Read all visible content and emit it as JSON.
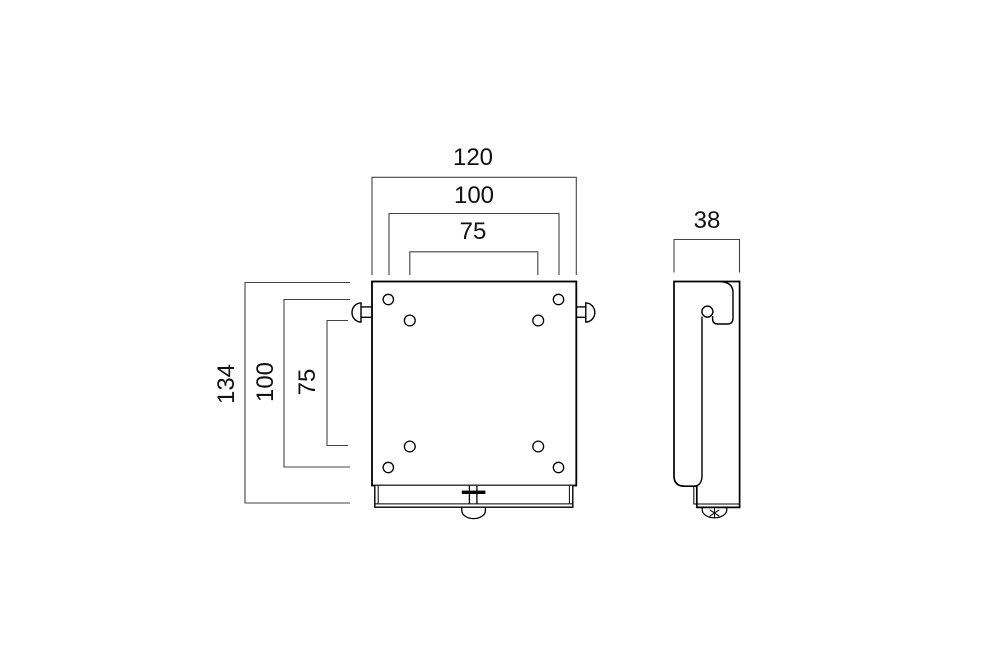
{
  "dimensions": {
    "front_width_outer": "120",
    "front_width_vesa_100": "100",
    "front_width_vesa_75": "75",
    "front_height_total": "134",
    "front_height_vesa_100": "100",
    "front_height_vesa_75": "75",
    "side_depth": "38"
  },
  "colors": {
    "background": "#ffffff",
    "part_line": "#000000",
    "dimension_line": "#444444",
    "label_text": "#111111"
  }
}
